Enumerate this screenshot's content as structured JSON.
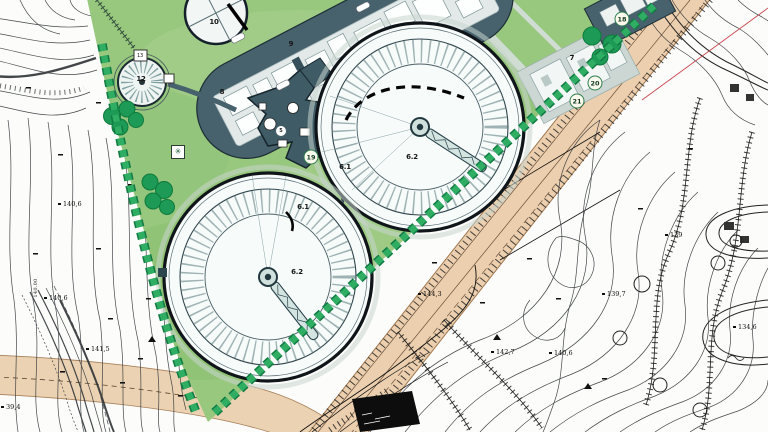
{
  "plan": {
    "structures": {
      "tank10_label": "10",
      "gasholder_label": "12",
      "gasholder_small_label": "13",
      "building7_label": "7",
      "building8_label": "8",
      "building9_label": "9",
      "connector_label": "5"
    },
    "clarifiers": [
      {
        "ring_label": "6.1",
        "center_label": "6.2"
      },
      {
        "ring_label": "6.1",
        "center_label": "6.2"
      }
    ],
    "circled_markers": [
      {
        "text": "18",
        "x": 622,
        "y": 19
      },
      {
        "text": "19",
        "x": 311,
        "y": 157
      },
      {
        "text": "20",
        "x": 595,
        "y": 83
      },
      {
        "text": "21",
        "x": 577,
        "y": 101
      }
    ],
    "spot_elevations": [
      {
        "text": "140,6",
        "x": 58,
        "y": 204
      },
      {
        "text": "140,6",
        "x": 44,
        "y": 298
      },
      {
        "text": "141,5",
        "x": 86,
        "y": 349
      },
      {
        "text": "39,4",
        "x": 1,
        "y": 407
      },
      {
        "text": "144,3",
        "x": 418,
        "y": 294
      },
      {
        "text": "142,7",
        "x": 491,
        "y": 352
      },
      {
        "text": "140,6",
        "x": 549,
        "y": 353
      },
      {
        "text": "139,7",
        "x": 602,
        "y": 294
      },
      {
        "text": "139",
        "x": 665,
        "y": 235
      },
      {
        "text": "134,6",
        "x": 733,
        "y": 327
      }
    ],
    "contour_label": "140.00",
    "icons": {
      "star_marker_glyph": "✳"
    },
    "palette": {
      "site_green": "#98c77e",
      "tree_green": "#1d9a55",
      "hedge_green": "#2aa35c",
      "road_tan": "#ebcfae",
      "slab_dark": "#47626d",
      "contour_ink": "#2f3438",
      "survey_red": "#c3333c"
    }
  }
}
